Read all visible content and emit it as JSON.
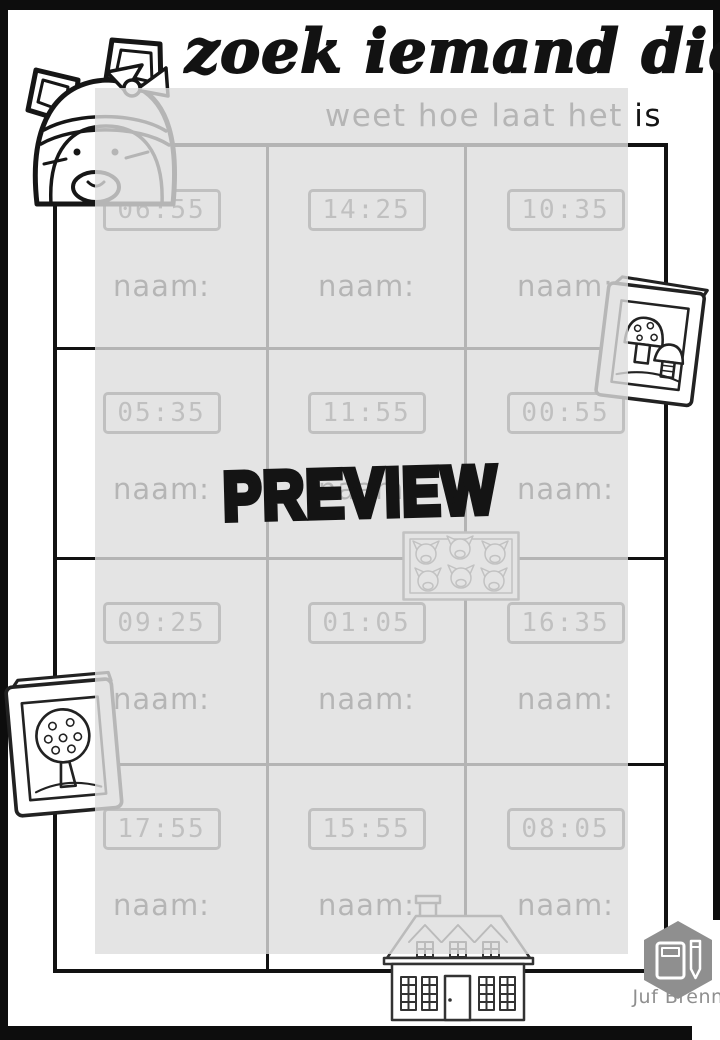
{
  "header": {
    "title": "zoek iemand die",
    "subtitle": "weet hoe laat het is"
  },
  "watermark": "PREVIEW",
  "worksheet": {
    "name_label": "naam:",
    "cells": [
      {
        "time": "06:55"
      },
      {
        "time": "14:25"
      },
      {
        "time": "10:35"
      },
      {
        "time": "05:35"
      },
      {
        "time": "11:55"
      },
      {
        "time": "00:55"
      },
      {
        "time": "09:25"
      },
      {
        "time": "01:05"
      },
      {
        "time": "16:35"
      },
      {
        "time": "17:55"
      },
      {
        "time": "15:55"
      },
      {
        "time": "08:05"
      }
    ]
  },
  "footer": {
    "brand": "Juf Brenn"
  },
  "icons": {
    "top_left": "cat-with-bow-illustration",
    "right_edge": "mushroom-book-illustration",
    "left_edge": "tree-book-illustration",
    "center": "fox-poster-illustration",
    "bottom": "house-illustration",
    "brand": "book-and-pencil-logo"
  },
  "colors": {
    "ink": "#121212",
    "overlay_tint": "#dddddd",
    "clock_ink": "#4a4a4a",
    "logo_gray": "#8f8f8f"
  }
}
